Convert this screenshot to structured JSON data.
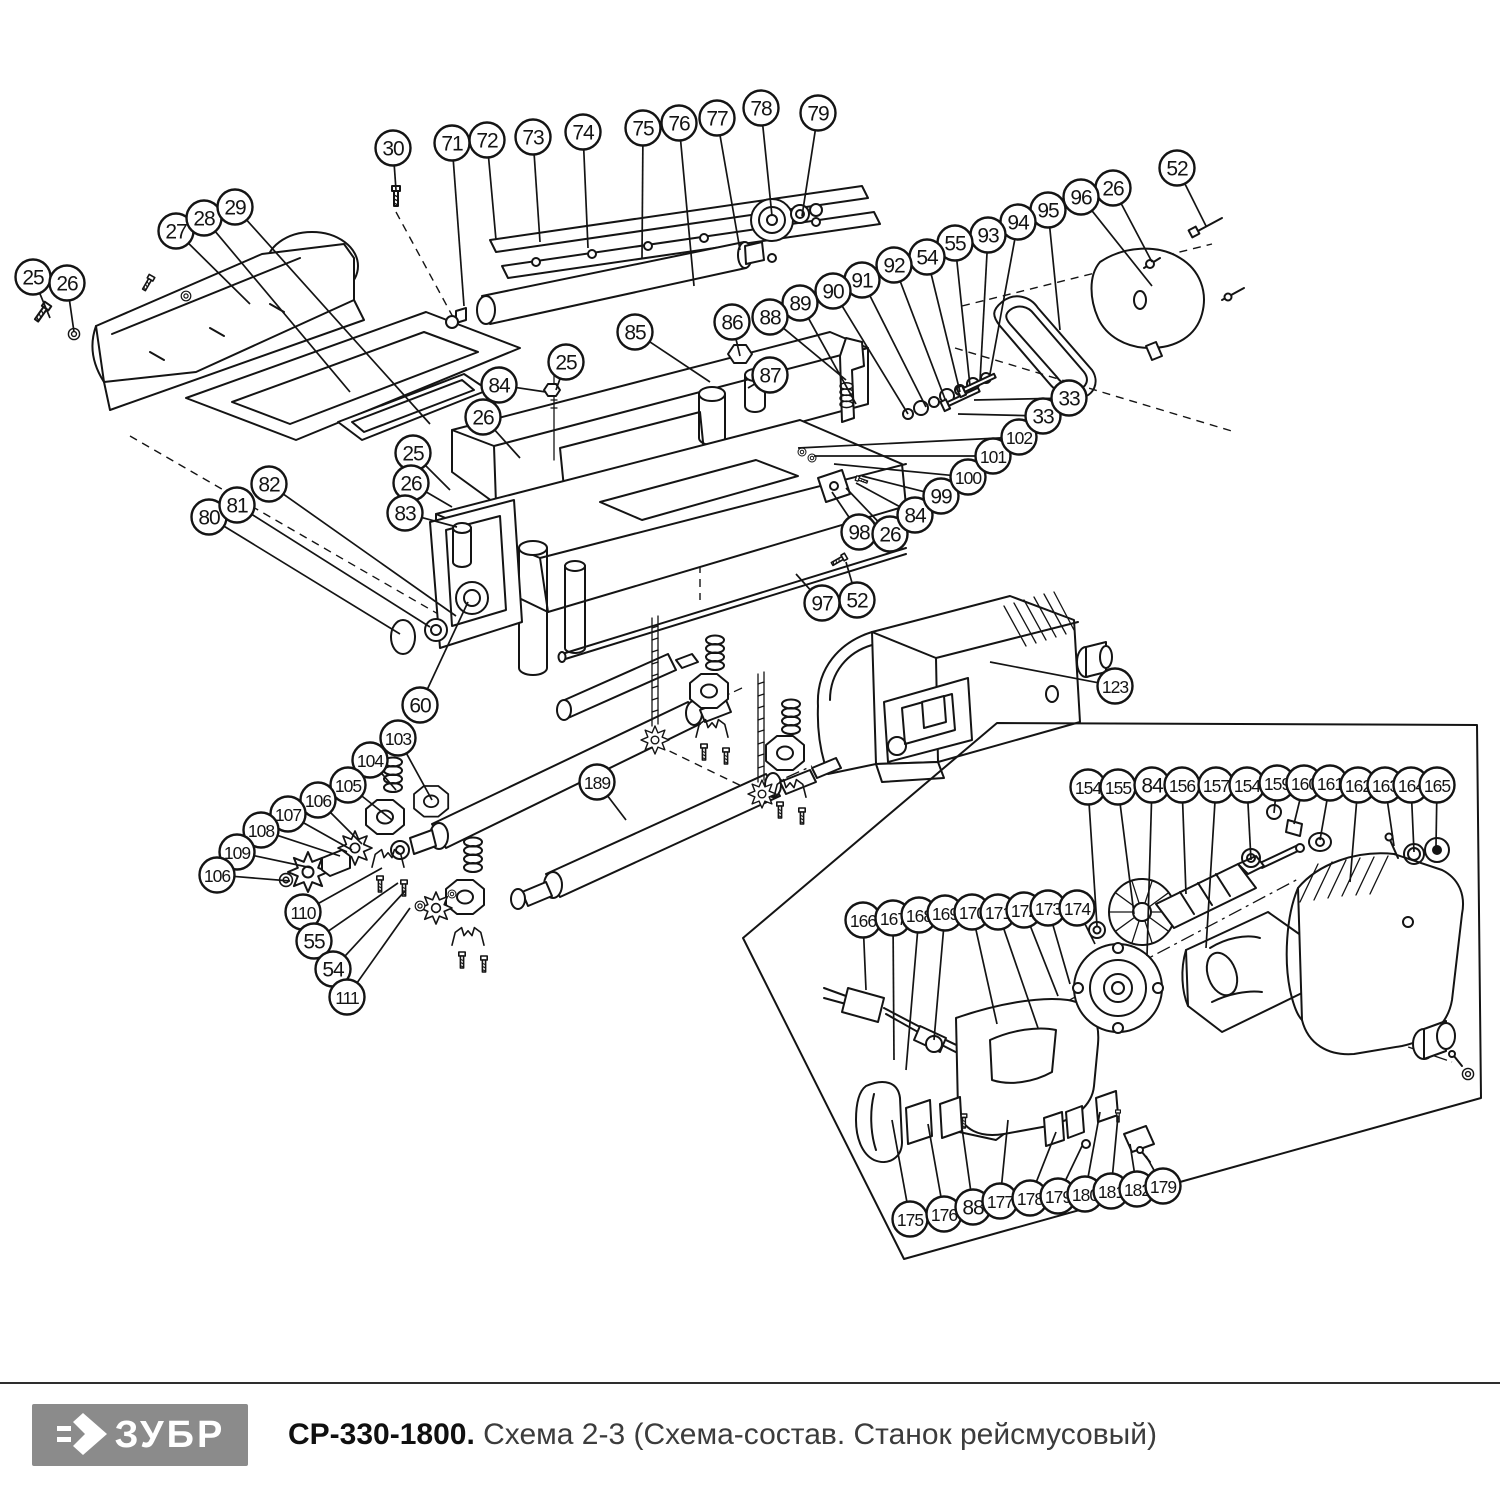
{
  "footer": {
    "logo_text": "ЗУБР",
    "logo_glyph": "double-chevron-arrow-icon",
    "title_bold": "СР-330-1800.",
    "title_rest": " Схема 2-3 (Схема-состав. Станок рейсмусовый)",
    "colors": {
      "logo_bg": "#8b8b8b",
      "rule": "#2e2e2e",
      "title_rest": "#3c3c3c"
    }
  },
  "diagram": {
    "description": "Exploded parts view of thickness planer with numbered callout balloons",
    "line_color": "#141414",
    "balloon": {
      "radius": 17.5,
      "font_size": 21,
      "font_size_small": 17.5
    },
    "balloon_fields": [
      "label",
      "cx",
      "cy",
      "target_x",
      "target_y"
    ],
    "balloons": [
      [
        "25",
        33,
        277,
        50,
        318
      ],
      [
        "26",
        67,
        283,
        74,
        332
      ],
      [
        "27",
        176,
        231,
        250,
        304
      ],
      [
        "28",
        204,
        218,
        350,
        392
      ],
      [
        "29",
        235,
        207,
        430,
        424
      ],
      [
        "30",
        393,
        148,
        396,
        190
      ],
      [
        "71",
        452,
        143,
        464,
        306
      ],
      [
        "72",
        487,
        140,
        496,
        240
      ],
      [
        "73",
        533,
        137,
        540,
        242
      ],
      [
        "74",
        583,
        132,
        588,
        248
      ],
      [
        "75",
        643,
        128,
        642,
        258
      ],
      [
        "76",
        679,
        123,
        694,
        286
      ],
      [
        "77",
        717,
        118,
        740,
        250
      ],
      [
        "78",
        761,
        108,
        772,
        216
      ],
      [
        "79",
        818,
        113,
        802,
        216
      ],
      [
        "52",
        1177,
        168,
        1206,
        226
      ],
      [
        "26",
        1113,
        188,
        1152,
        262
      ],
      [
        "96",
        1081,
        197,
        1152,
        286
      ],
      [
        "95",
        1048,
        210,
        1060,
        330
      ],
      [
        "94",
        1018,
        222,
        990,
        374
      ],
      [
        "93",
        988,
        235,
        980,
        381
      ],
      [
        "55",
        955,
        243,
        970,
        386
      ],
      [
        "54",
        927,
        257,
        960,
        392
      ],
      [
        "92",
        894,
        265,
        945,
        399
      ],
      [
        "91",
        862,
        280,
        926,
        407
      ],
      [
        "90",
        833,
        291,
        908,
        414
      ],
      [
        "89",
        800,
        303,
        856,
        404
      ],
      [
        "88",
        770,
        317,
        846,
        380
      ],
      [
        "86",
        732,
        322,
        740,
        356
      ],
      [
        "87",
        770,
        375,
        748,
        388
      ],
      [
        "85",
        635,
        332,
        710,
        382
      ],
      [
        "25",
        566,
        362,
        556,
        390
      ],
      [
        "84",
        499,
        385,
        546,
        392
      ],
      [
        "26",
        483,
        417,
        520,
        458
      ],
      [
        "25",
        413,
        453,
        450,
        490
      ],
      [
        "26",
        411,
        483,
        452,
        507
      ],
      [
        "83",
        405,
        513,
        457,
        527
      ],
      [
        "80",
        209,
        517,
        400,
        634
      ],
      [
        "81",
        237,
        505,
        430,
        627
      ],
      [
        "82",
        269,
        484,
        456,
        616
      ],
      [
        "60",
        420,
        705,
        468,
        602
      ],
      [
        "103",
        398,
        738,
        432,
        800
      ],
      [
        "104",
        370,
        760,
        396,
        790
      ],
      [
        "105",
        348,
        785,
        392,
        820
      ],
      [
        "106",
        318,
        800,
        362,
        844
      ],
      [
        "107",
        288,
        814,
        352,
        850
      ],
      [
        "108",
        261,
        830,
        340,
        856
      ],
      [
        "109",
        237,
        852,
        312,
        868
      ],
      [
        "106",
        217,
        875,
        290,
        881
      ],
      [
        "110",
        303,
        912,
        382,
        868
      ],
      [
        "55",
        314,
        941,
        398,
        883
      ],
      [
        "54",
        333,
        969,
        406,
        890
      ],
      [
        "111",
        347,
        997,
        410,
        908
      ],
      [
        "97",
        822,
        603,
        796,
        574
      ],
      [
        "52",
        857,
        600,
        846,
        562
      ],
      [
        "98",
        859,
        532,
        832,
        492
      ],
      [
        "26",
        890,
        534,
        846,
        488
      ],
      [
        "84",
        915,
        515,
        856,
        483
      ],
      [
        "99",
        941,
        496,
        862,
        476
      ],
      [
        "100",
        968,
        477,
        834,
        464
      ],
      [
        "101",
        993,
        456,
        814,
        456
      ],
      [
        "102",
        1019,
        437,
        798,
        448
      ],
      [
        "33",
        1043,
        416,
        958,
        414
      ],
      [
        "33",
        1069,
        398,
        974,
        400
      ],
      [
        "123",
        1115,
        686,
        990,
        662
      ],
      [
        "189",
        597,
        782,
        626,
        820
      ],
      [
        "154",
        1088,
        787,
        1097,
        926
      ],
      [
        "155",
        1118,
        787,
        1134,
        914
      ],
      [
        "84",
        1152,
        785,
        1147,
        956
      ],
      [
        "156",
        1182,
        785,
        1186,
        894
      ],
      [
        "157",
        1216,
        785,
        1206,
        948
      ],
      [
        "154",
        1247,
        785,
        1251,
        860
      ],
      [
        "159",
        1277,
        783,
        1274,
        813
      ],
      [
        "160",
        1304,
        783,
        1294,
        824
      ],
      [
        "161",
        1330,
        783,
        1320,
        840
      ],
      [
        "162",
        1358,
        785,
        1350,
        882
      ],
      [
        "163",
        1385,
        785,
        1394,
        846
      ],
      [
        "164",
        1411,
        785,
        1414,
        852
      ],
      [
        "165",
        1437,
        785,
        1436,
        846
      ],
      [
        "166",
        863,
        920,
        866,
        990
      ],
      [
        "167",
        893,
        918,
        894,
        1060
      ],
      [
        "168",
        919,
        915,
        906,
        1070
      ],
      [
        "169",
        945,
        913,
        934,
        1040
      ],
      [
        "170",
        972,
        912,
        997,
        1024
      ],
      [
        "171",
        998,
        912,
        1038,
        1028
      ],
      [
        "172",
        1024,
        910,
        1058,
        996
      ],
      [
        "173",
        1048,
        908,
        1070,
        984
      ],
      [
        "174",
        1077,
        908,
        1095,
        944
      ],
      [
        "175",
        910,
        1219,
        892,
        1120
      ],
      [
        "176",
        944,
        1214,
        928,
        1124
      ],
      [
        "88",
        973,
        1207,
        962,
        1128
      ],
      [
        "177",
        1000,
        1201,
        1008,
        1120
      ],
      [
        "178",
        1030,
        1198,
        1056,
        1132
      ],
      [
        "179",
        1058,
        1196,
        1082,
        1146
      ],
      [
        "180",
        1085,
        1194,
        1100,
        1112
      ],
      [
        "181",
        1111,
        1191,
        1118,
        1116
      ],
      [
        "182",
        1137,
        1189,
        1130,
        1144
      ],
      [
        "179",
        1163,
        1186,
        1146,
        1156
      ]
    ]
  }
}
